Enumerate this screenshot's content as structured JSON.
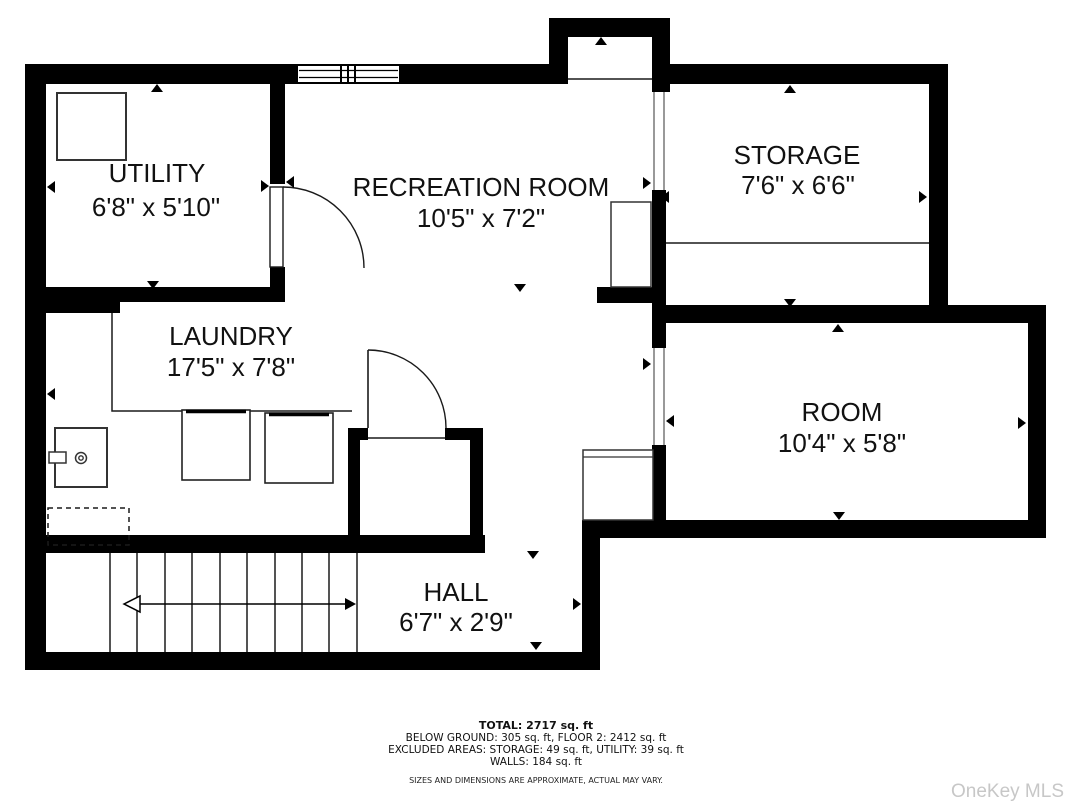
{
  "floor_plan": {
    "rooms": {
      "utility": {
        "name": "UTILITY",
        "dims": "6'8\" x 5'10\""
      },
      "recreation": {
        "name": "RECREATION ROOM",
        "dims": "10'5\" x 7'2\""
      },
      "storage": {
        "name": "STORAGE",
        "dims": "7'6\" x 6'6\""
      },
      "laundry": {
        "name": "LAUNDRY",
        "dims": "17'5\" x 7'8\""
      },
      "room": {
        "name": "ROOM",
        "dims": "10'4\" x 5'8\""
      },
      "hall": {
        "name": "HALL",
        "dims": "6'7\" x 2'9\""
      }
    },
    "summary": {
      "total": "TOTAL: 2717 sq. ft",
      "below_ground": "BELOW GROUND: 305 sq. ft, FLOOR 2: 2412 sq. ft",
      "excluded": "EXCLUDED AREAS: STORAGE: 49 sq. ft, UTILITY: 39 sq. ft",
      "walls": "WALLS: 184 sq. ft",
      "disclaimer": "SIZES AND DIMENSIONS ARE APPROXIMATE, ACTUAL MAY VARY."
    },
    "watermark": "OneKey MLS",
    "colors": {
      "wall": "#000000",
      "background": "#ffffff",
      "watermark": "#c7c7c7"
    }
  }
}
